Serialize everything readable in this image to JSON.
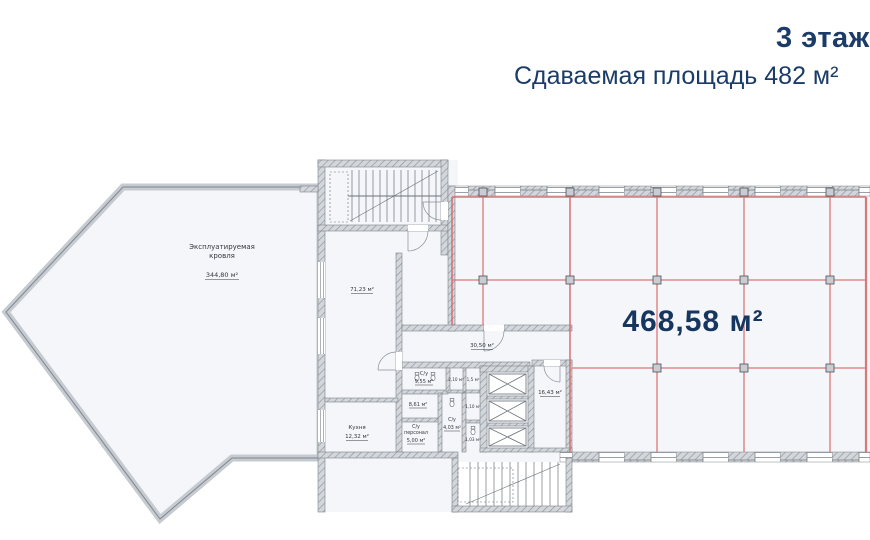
{
  "header": {
    "floor_title": "3 этаж",
    "subtitle": "Сдаваемая площадь 482 м²"
  },
  "plan": {
    "roof_terrace": {
      "name_line1": "Эксплуатируемая",
      "name_line2": "кровля",
      "area": "344,80 м²"
    },
    "open_space": {
      "area": "468,58 м²"
    },
    "rooms": {
      "room_71": {
        "area": "71,23 м²"
      },
      "corridor": {
        "area": "30,50 м²"
      },
      "wc_main": {
        "name": "С/у",
        "area": "9,55 м²"
      },
      "room_861": {
        "area": "8,61 м²"
      },
      "kitchen": {
        "name": "Кухня",
        "area": "12,32 м²"
      },
      "wc_staff": {
        "name_line1": "С/у",
        "name_line2": "персонал",
        "area": "5,00 м²"
      },
      "wc_small": {
        "name": "С/у",
        "area": "4,03 м²"
      },
      "lobby": {
        "area": "16,43 м²"
      },
      "stall_1": {
        "area": "2,10 м²"
      },
      "stall_2": {
        "area": "1,5 м²"
      },
      "stall_3": {
        "area": "1,10 м²"
      },
      "stall_4": {
        "area": "1,03 м²"
      }
    },
    "colors": {
      "title_navy": "#1b3c68",
      "lease_red": "#d96a6a",
      "wall_gray": "#9aa0a6",
      "floor_fill": "#f4f6f9"
    }
  }
}
